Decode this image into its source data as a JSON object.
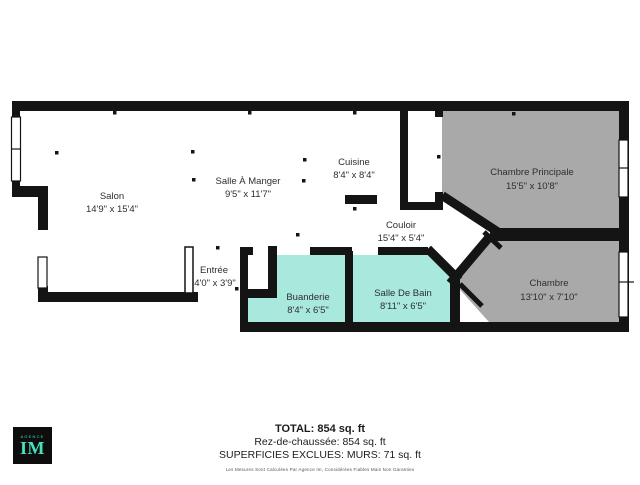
{
  "colors": {
    "wall": "#141414",
    "bedroom_fill": "#a9a9a9",
    "wet_room_fill": "#a9e8dd",
    "floor_fill": "#ffffff",
    "logo_bg": "#0d0d0d",
    "logo_accent": "#47e0c0"
  },
  "rooms": [
    {
      "id": "salon",
      "name": "Salon",
      "dims": "14'9\" x 15'4\""
    },
    {
      "id": "salle-a-manger",
      "name": "Salle À Manger",
      "dims": "9'5\" x 11'7\""
    },
    {
      "id": "cuisine",
      "name": "Cuisine",
      "dims": "8'4\" x 8'4\""
    },
    {
      "id": "chambre-principale",
      "name": "Chambre Principale",
      "dims": "15'5\" x 10'8\""
    },
    {
      "id": "couloir",
      "name": "Couloir",
      "dims": "15'4\" x 5'4\""
    },
    {
      "id": "entree",
      "name": "Entrée",
      "dims": "4'0\" x 3'9\""
    },
    {
      "id": "buanderie",
      "name": "Buanderie",
      "dims": "8'4\" x 6'5\""
    },
    {
      "id": "salle-de-bain",
      "name": "Salle De Bain",
      "dims": "8'11\" x 6'5\""
    },
    {
      "id": "chambre",
      "name": "Chambre",
      "dims": "13'10\" x 7'10\""
    }
  ],
  "summary": {
    "total": "TOTAL: 854 sq. ft",
    "floor": "Rez-de-chaussée: 854 sq. ft",
    "excluded": "SUPERFICIES EXCLUES: MURS: 71 sq. ft",
    "disclaimer": "Les Mesures Sont Calculées Par Agence Im, Considérées Fiables Mais Non Garanties"
  },
  "logo": {
    "agency": "AGENCE",
    "monogram": "IM"
  }
}
